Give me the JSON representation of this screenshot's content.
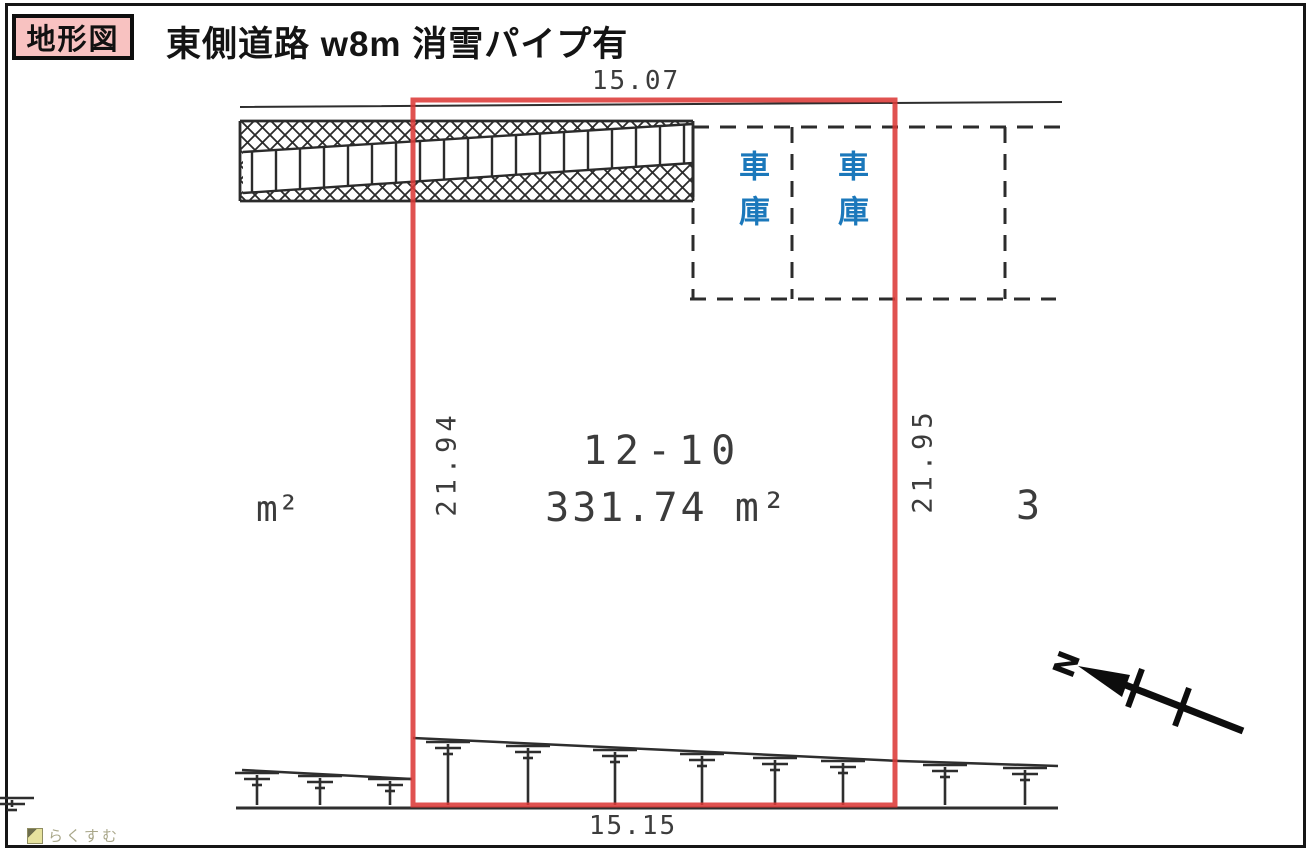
{
  "page": {
    "doc_label": "地形図",
    "road_note": "東側道路 w8m 消雪パイプ有",
    "watermark": "らくすむ"
  },
  "plan": {
    "parcel": {
      "number": "12-10",
      "area": "331.74 m²"
    },
    "dimensions": {
      "top": "15.07",
      "bottom": "15.15",
      "left": "21.94",
      "right": "21.95"
    },
    "garages": [
      {
        "label": "車庫"
      },
      {
        "label": "車庫"
      }
    ],
    "neighbors": {
      "left_unit": "m²",
      "right_lot": "3"
    },
    "compass": {
      "label": "N"
    }
  },
  "colors": {
    "parcel_outline": "#dc3a38",
    "garage_text": "#1b78bb",
    "doc_label_bg": "#f8c2c1",
    "ink": "#2e2e2e",
    "watermark": "#a9a78a"
  }
}
